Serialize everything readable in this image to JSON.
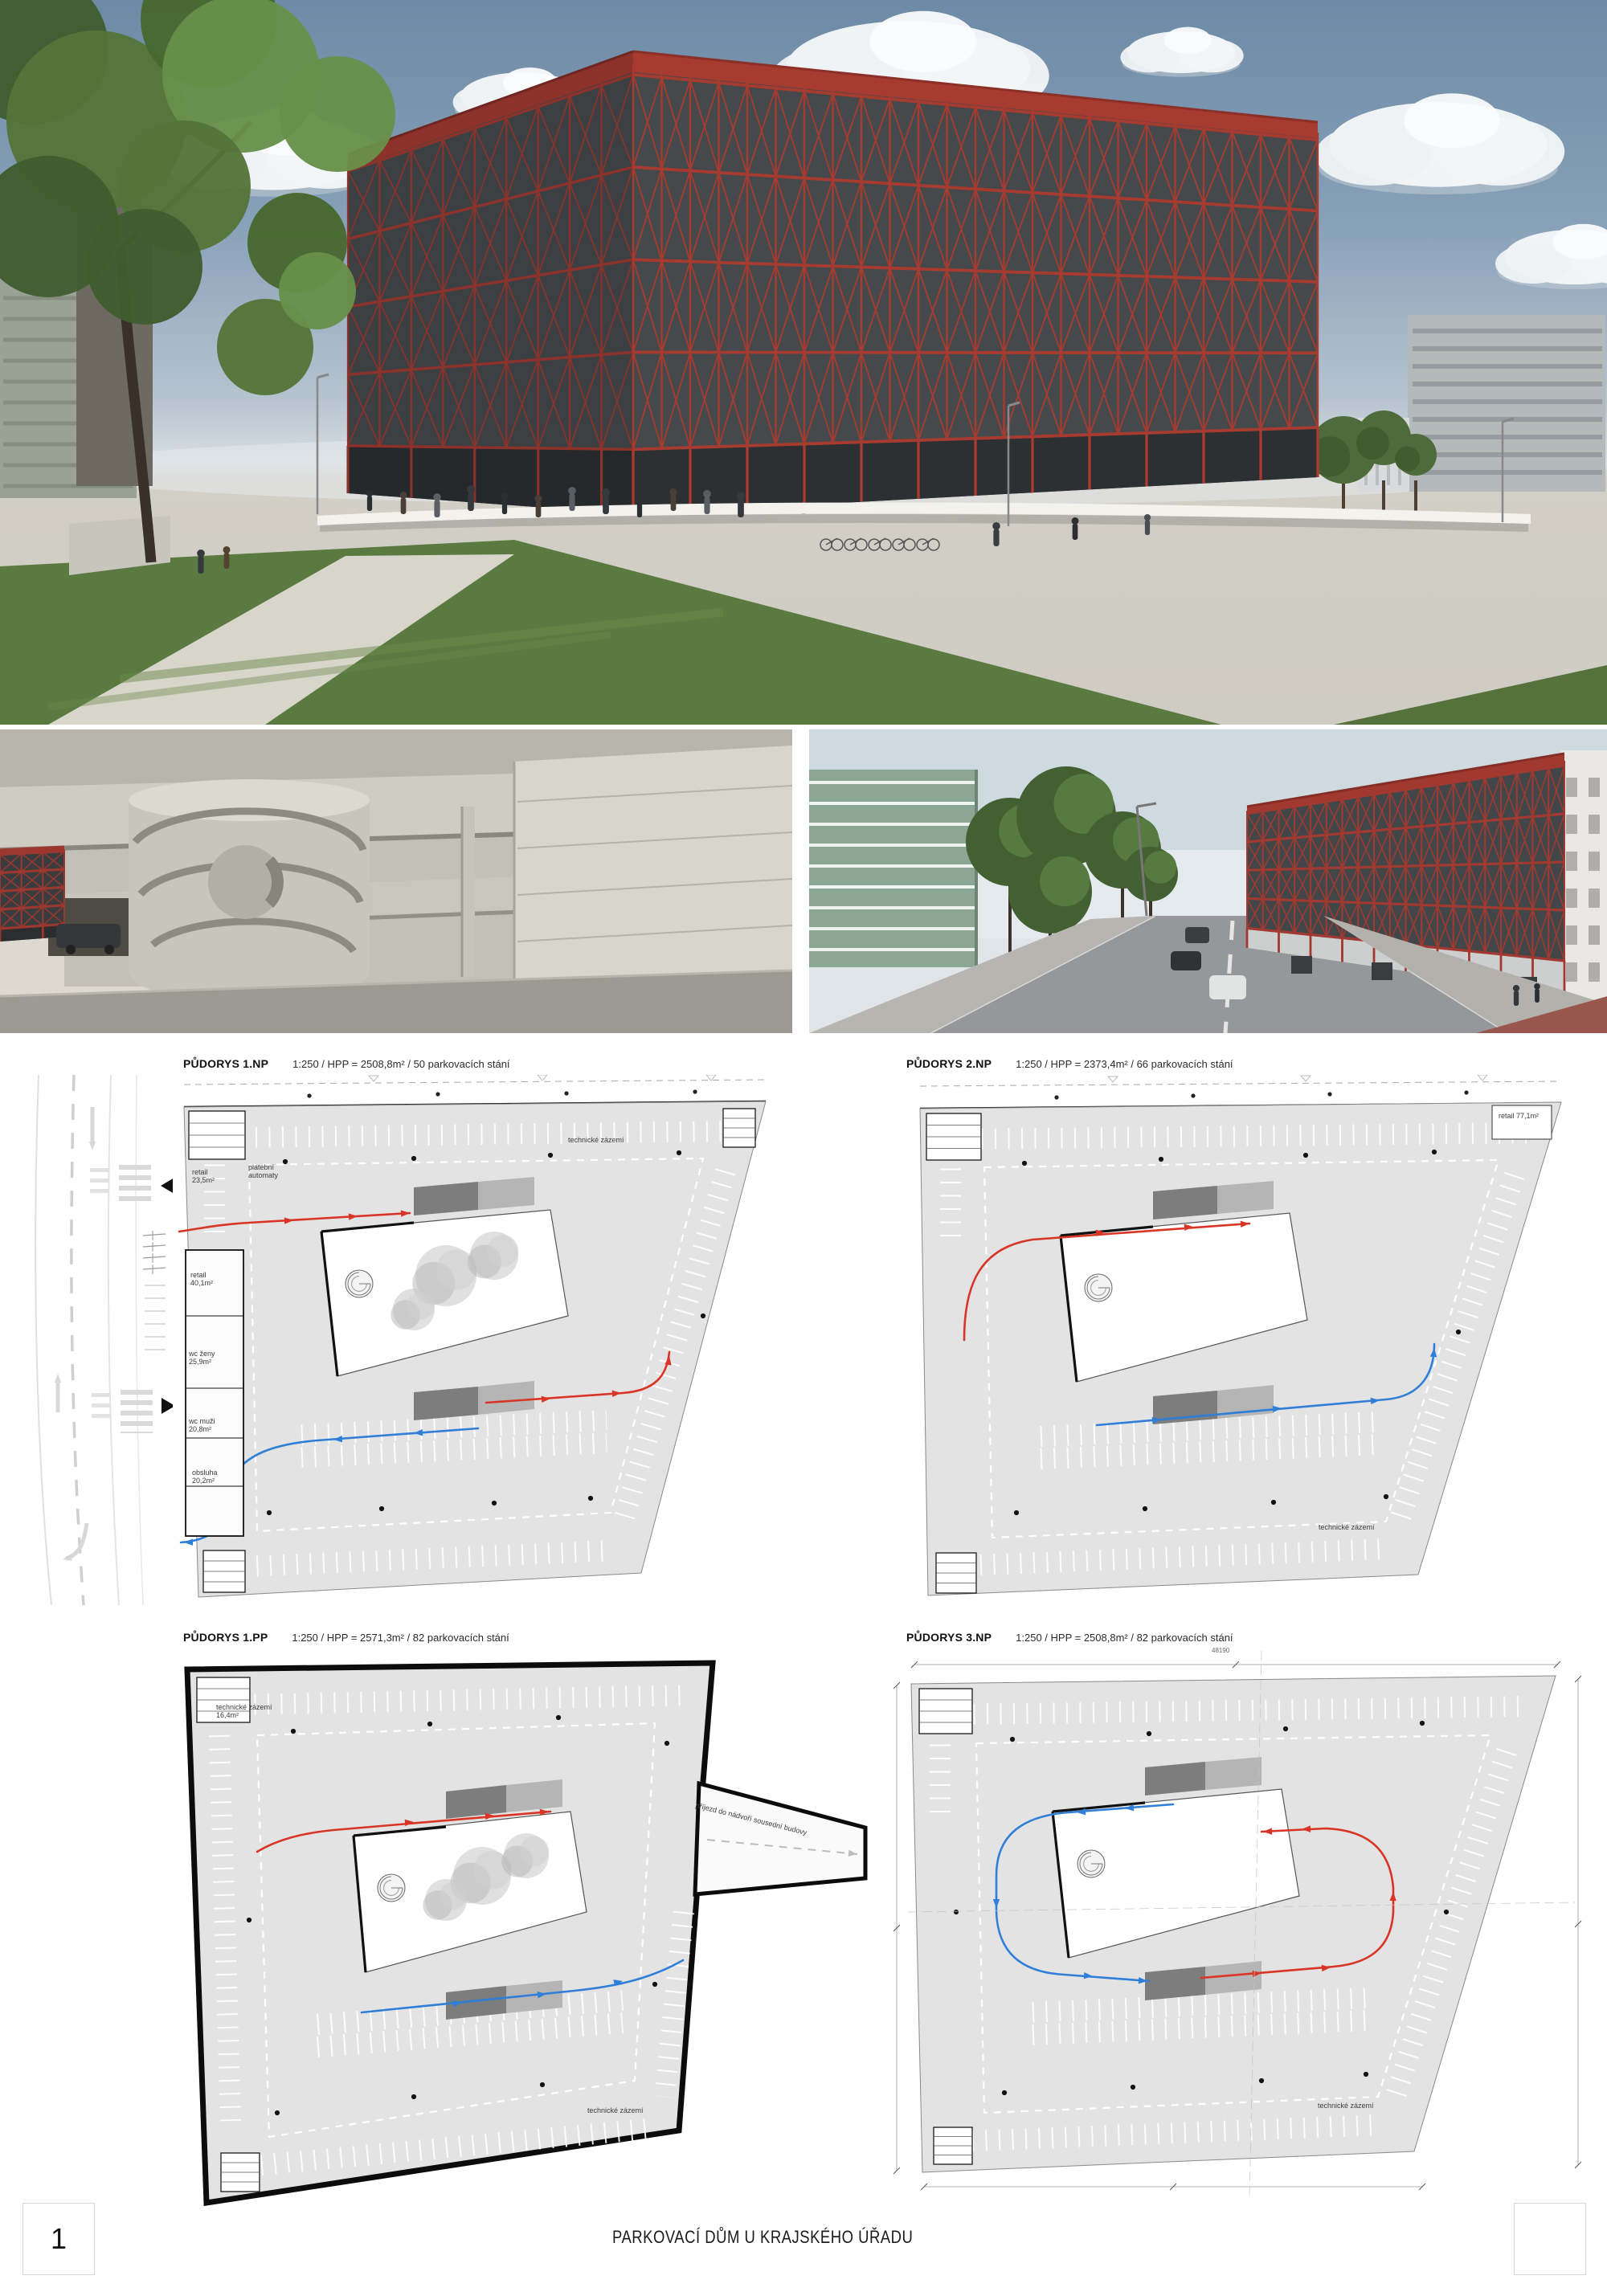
{
  "board": {
    "footer_title": "PARKOVACÍ DŮM U KRAJSKÉHO ÚŘADU",
    "page_number": "1"
  },
  "renders": {
    "hero": "exterior rendering - red lattice parking house",
    "interior": "interior rendering - concrete spiral ramp",
    "street": "street rendering - parking house from crossroad"
  },
  "plans": [
    {
      "name": "PŮDORYS 1.NP",
      "specs": "1:250 / HPP = 2508,8m² / 50 parkovacích stání",
      "labels": {
        "tech_right": "technické zázemí",
        "retail_small": "retail 23,5m²",
        "pay": "platební automaty",
        "retail_mid": "retail 40,1m²",
        "wc_women": "wc ženy 25,9m²",
        "wc_men": "wc muži 20,8m²",
        "service": "obsluha 20,2m²"
      }
    },
    {
      "name": "PŮDORYS 2.NP",
      "specs": "1:250 / HPP = 2373,4m² / 66 parkovacích stání",
      "labels": {
        "retail_tr": "retail 77,1m²",
        "tech_br": "technické zázemí"
      }
    },
    {
      "name": "PŮDORYS 1.PP",
      "specs": "1:250 / HPP = 2571,3m² / 82 parkovacích stání",
      "labels": {
        "tech_tl": "technické zázemí 16,4m²",
        "driveway": "příjezd do nádvoří sousední budovy",
        "tech_br": "technické zázemí"
      }
    },
    {
      "name": "PŮDORYS 3.NP",
      "specs": "1:250 / HPP = 2508,8m² / 82 parkovacích stání",
      "labels": {
        "dim_top": "48190",
        "tech_br": "technické zázemí"
      }
    }
  ],
  "colors": {
    "facade_red": "#a23a31",
    "plan_field_gray": "#e3e3e3",
    "circulation_red": "#d93425",
    "circulation_blue": "#2f7fd8"
  }
}
